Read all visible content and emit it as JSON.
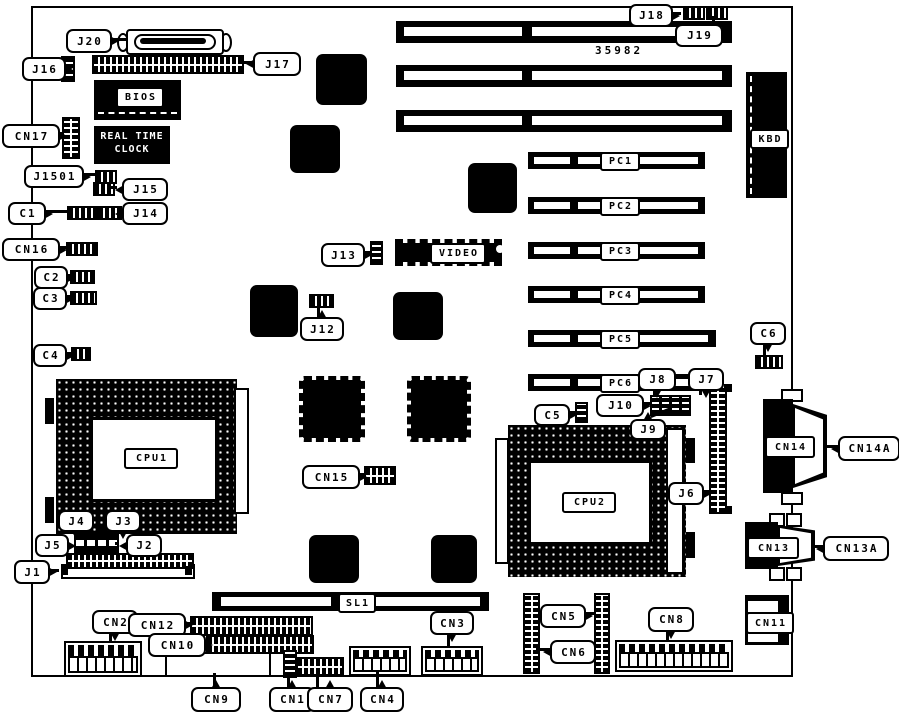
{
  "board": {
    "part_number": "35982"
  },
  "labels": {
    "j20": "J20",
    "j17": "J17",
    "j16": "J16",
    "cn17": "CN17",
    "bios": "BIOS",
    "rtc_line1": "REAL TIME",
    "rtc_line2": "CLOCK",
    "j1501": "J1501",
    "j15": "J15",
    "c1": "C1",
    "j14": "J14",
    "cn16": "CN16",
    "c2": "C2",
    "c3": "C3",
    "c4": "C4",
    "cpu1": "CPU1",
    "j4": "J4",
    "j3": "J3",
    "j5": "J5",
    "j2": "J2",
    "j1": "J1",
    "cn2": "CN2",
    "cn12": "CN12",
    "cn10": "CN10",
    "cn9": "CN9",
    "cn1": "CN1",
    "cn7": "CN7",
    "cn4": "CN4",
    "cn3": "CN3",
    "sl1": "SL1",
    "cn15": "CN15",
    "j12": "J12",
    "j13": "J13",
    "video": "VIDEO",
    "j18": "J18",
    "j19": "J19",
    "kbd": "KBD",
    "pc1": "PC1",
    "pc2": "PC2",
    "pc3": "PC3",
    "pc4": "PC4",
    "pc5": "PC5",
    "pc6": "PC6",
    "c6": "C6",
    "j8": "J8",
    "j7": "J7",
    "j10": "J10",
    "j9": "J9",
    "c5": "C5",
    "cpu2": "CPU2",
    "j6": "J6",
    "cn14": "CN14",
    "cn14a": "CN14A",
    "cn13": "CN13",
    "cn13a": "CN13A",
    "cn5": "CN5",
    "cn6": "CN6",
    "cn8": "CN8",
    "cn11": "CN11"
  }
}
